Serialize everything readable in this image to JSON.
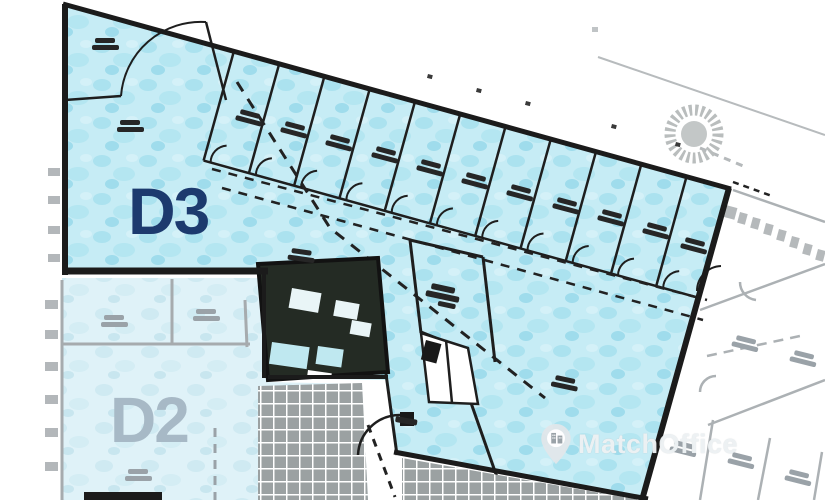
{
  "plan": {
    "unit_label": "D3",
    "adjacent_unit_label": "D2",
    "zones": [
      {
        "id": "D3",
        "label": "D3",
        "style": "highlighted-blue-unit"
      },
      {
        "id": "D2",
        "label": "D2",
        "style": "faded-background-unit"
      }
    ],
    "colors": {
      "unit_fill": "#c6ecf5",
      "unit_fill_spot": "#a9e1ee",
      "wall": "#1b1b1b",
      "unit_label_color": "#1c3a6e",
      "adjacent_label_color": "#a7b9c6",
      "faded_line": "#a6abae",
      "core_fill": "#242b24",
      "hatch_gray": "#9ba1a2"
    }
  },
  "watermark": {
    "brand": "MatchOffice",
    "icon": "map-pin-building"
  }
}
